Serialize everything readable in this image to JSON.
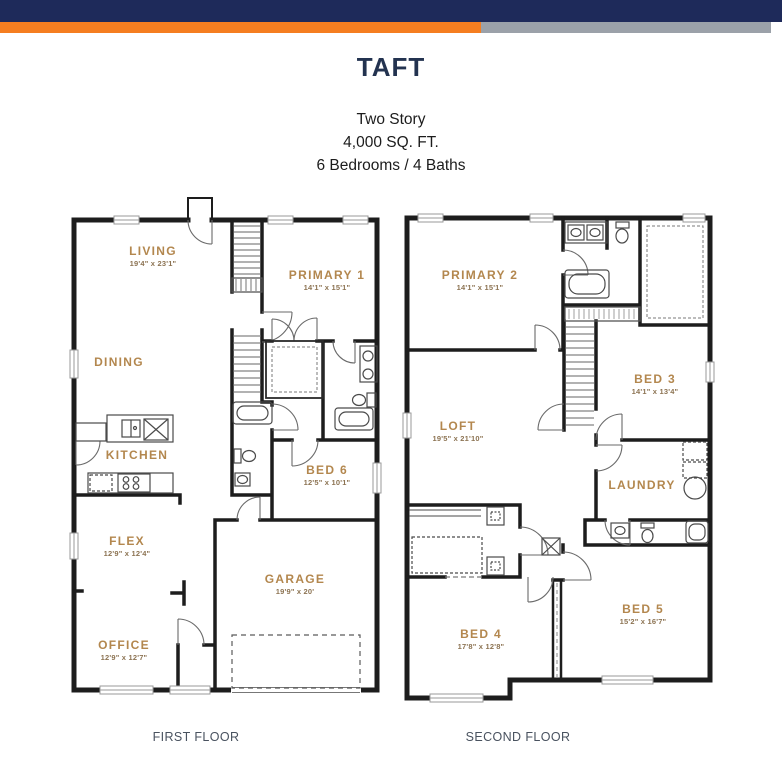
{
  "header": {
    "title": "TAFT",
    "subtitle_lines": [
      "Two Story",
      "4,000 SQ. FT.",
      "6 Bedrooms / 4 Baths"
    ],
    "brand_colors": {
      "navy": "#1e2a5a",
      "orange": "#f57e20",
      "gray": "#9ba1a9"
    }
  },
  "first_floor": {
    "caption": "FIRST FLOOR",
    "rooms": [
      {
        "name": "LIVING",
        "dims": "19'4\" x 23'1\""
      },
      {
        "name": "PRIMARY 1",
        "dims": "14'1\" x 15'1\""
      },
      {
        "name": "DINING",
        "dims": ""
      },
      {
        "name": "KITCHEN",
        "dims": ""
      },
      {
        "name": "BED 6",
        "dims": "12'5\" x 10'1\""
      },
      {
        "name": "FLEX",
        "dims": "12'9\" x 12'4\""
      },
      {
        "name": "GARAGE",
        "dims": "19'9\" x 20'"
      },
      {
        "name": "OFFICE",
        "dims": "12'9\" x 12'7\""
      }
    ]
  },
  "second_floor": {
    "caption": "SECOND FLOOR",
    "rooms": [
      {
        "name": "PRIMARY 2",
        "dims": "14'1\" x 15'1\""
      },
      {
        "name": "BED 3",
        "dims": "14'1\" x 13'4\""
      },
      {
        "name": "LOFT",
        "dims": "19'5\" x 21'10\""
      },
      {
        "name": "LAUNDRY",
        "dims": ""
      },
      {
        "name": "BED 4",
        "dims": "17'8\" x 12'8\""
      },
      {
        "name": "BED 5",
        "dims": "15'2\" x 16'7\""
      }
    ]
  },
  "style_colors": {
    "room_label": "#b3874e",
    "room_dims": "#8c7352",
    "walls": "#1d1d1d"
  }
}
